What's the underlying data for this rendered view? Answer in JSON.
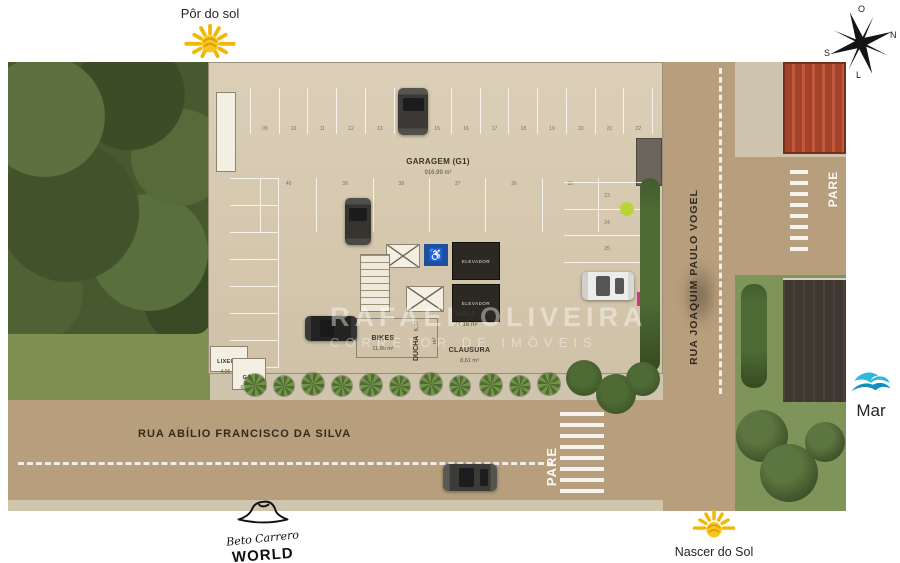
{
  "annotations": {
    "sunset_label": "Pôr do sol",
    "sunrise_label": "Nascer do Sol",
    "sea_label": "Mar"
  },
  "compass": {
    "top": "O",
    "right": "N",
    "bottom": "L",
    "left": "S"
  },
  "watermark": {
    "name": "RAFAEL OLIVEIRA",
    "role": "CORRETOR DE IMÓVEIS"
  },
  "streets": {
    "south_name": "RUA ABÍLIO FRANCISCO DA SILVA",
    "east_name": "RUA JOAQUIM PAULO VOGEL",
    "stop": "PARE"
  },
  "garage": {
    "title": "GARAGEM (G1)",
    "area": "916,99 m²",
    "elevator": "ELEVADOR",
    "rooms": {
      "hall": {
        "name": "HALL",
        "area": "24,16 m²"
      },
      "bikes": {
        "name": "BIKES",
        "area": "11,90 m²"
      },
      "ducha": {
        "name": "DUCHA",
        "area": "6,37 m²"
      },
      "clausura": {
        "name": "CLAUSURA",
        "area": "8,61 m²"
      },
      "lixeira": {
        "name": "LIXEIRA",
        "area": "4,06 m²"
      },
      "gas": {
        "name": "GÁS",
        "area": "6,06 m²"
      }
    }
  },
  "parking": {
    "top_row": [
      "09",
      "10",
      "11",
      "12",
      "13",
      "14",
      "15",
      "16",
      "17",
      "18",
      "19",
      "20",
      "21",
      "22"
    ],
    "middle_row": [
      "40",
      "39",
      "38",
      "37",
      "36",
      "35"
    ],
    "right_column": [
      "23",
      "24",
      "25"
    ]
  },
  "icons": {
    "accessibility": "♿"
  },
  "logo": {
    "script": "Beto Carrero",
    "word": "WORLD"
  },
  "colors": {
    "street": "#b79e7d",
    "building": "#d5c8af",
    "forest": "#49592f",
    "sun": "#f2b705",
    "sea": "#2fb9dd",
    "red_roof": "#a4422a",
    "accent_green": "#b8d438"
  }
}
